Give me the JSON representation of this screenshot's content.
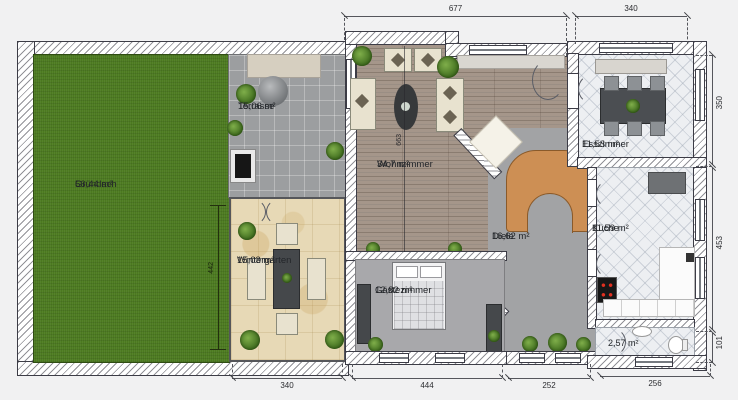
{
  "plan": {
    "rooms": {
      "gruendach": {
        "name": "Gründach",
        "area": "56,44 m²"
      },
      "terrasse": {
        "name": "Terrasse",
        "area": "15,06 m²"
      },
      "wintergarten": {
        "name": "Wintergarten",
        "area": "15,03 m²"
      },
      "wohnzimmer": {
        "name": "Wohnzimmer",
        "area": "34,7 m²"
      },
      "esszimmer": {
        "name": "Esszimmer",
        "area": "11,53 m²"
      },
      "kueche": {
        "name": "Küche",
        "area": "11,59 m²"
      },
      "diele": {
        "name": "Diele",
        "area": "16,62 m²"
      },
      "gaestezimmer": {
        "name": "Gästezimmer",
        "area": "12,82 m²"
      },
      "wc": {
        "area": "2,57 m²"
      }
    },
    "dims": {
      "top_main": "677",
      "top_right": "340",
      "right_upper": "350",
      "right_middle": "453",
      "right_lower": "101",
      "bottom_wintergarten": "340",
      "bottom_gaestezimmer": "444",
      "bottom_diele": "252",
      "bottom_wc": "256",
      "left_wintergarten": "442",
      "wohnzimmer_height": "663"
    },
    "colors": {
      "green_roof": "#4c7a20",
      "terrace_tile": "#9c9ea0",
      "sandstone": "#e7d9b6",
      "wood_floor": "#a5968a",
      "light_tile": "#edeff2",
      "gray_floor": "#a8a8ab",
      "stair_wood": "#cd8f54",
      "wall": "#ffffff"
    }
  }
}
